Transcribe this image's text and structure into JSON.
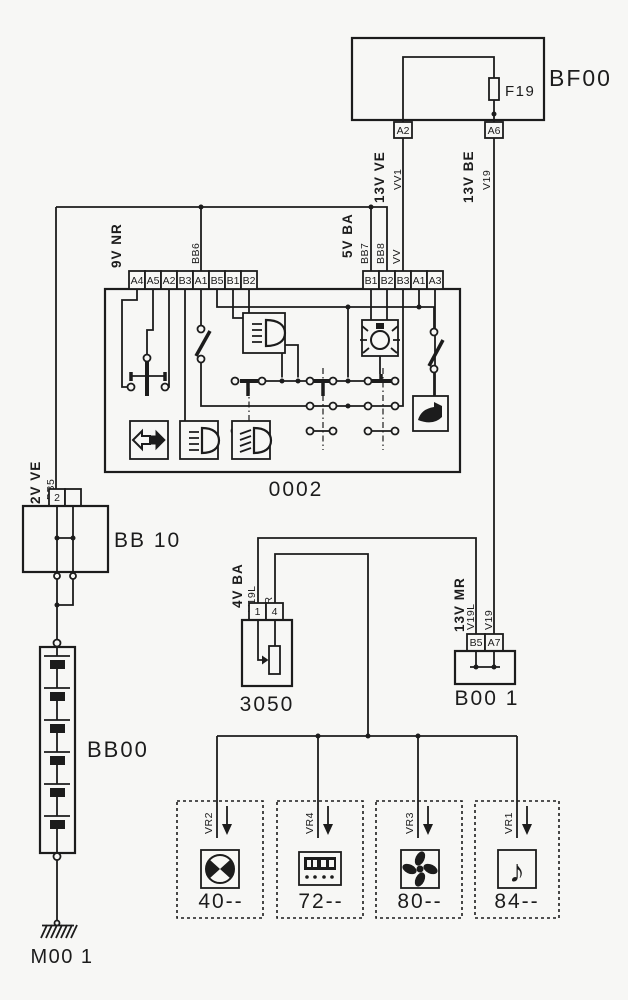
{
  "title": "wiring-diagram",
  "colors": {
    "line": "#1c1c1c",
    "paper": "#f7f7f5"
  },
  "bf00": {
    "label": "BF00",
    "fuse": "F19",
    "pin_a2": "A2",
    "pin_a6": "A6",
    "wire_a2_label": "13V VE",
    "wire_a2_code": "VV1",
    "wire_a6_label": "13V BE",
    "wire_a6_code": "V19"
  },
  "c0002": {
    "label": "0002",
    "left_bus": "9V NR",
    "left_code": "BB6",
    "left_pins": [
      "A4",
      "A5",
      "A2",
      "B3",
      "A1",
      "B5",
      "B1",
      "B2"
    ],
    "right_bus": "5V BA",
    "right_codes": [
      "BB7",
      "BB8",
      "VV"
    ],
    "right_pins": [
      "B1",
      "B2",
      "B3",
      "A1",
      "A3"
    ]
  },
  "bb10": {
    "label": "BB 10",
    "pin": "2",
    "bus": "2V VE",
    "code": "BB5"
  },
  "bb00": {
    "label": "BB00"
  },
  "m001": {
    "label": "M00 1"
  },
  "u3050": {
    "label": "3050",
    "bus": "4V BA",
    "pins": [
      "1",
      "4"
    ],
    "codes": [
      "V19L",
      "VR"
    ]
  },
  "b001": {
    "label": "B00 1",
    "bus": "13V MR",
    "pins": [
      "B5",
      "A7"
    ],
    "codes": [
      "V19L",
      "V19"
    ]
  },
  "loads": [
    {
      "wire": "VR2",
      "num": "40--",
      "icon": "air-distribution-icon"
    },
    {
      "wire": "VR4",
      "num": "72--",
      "icon": "digital-clock-icon"
    },
    {
      "wire": "VR3",
      "num": "80--",
      "icon": "fan-icon"
    },
    {
      "wire": "VR1",
      "num": "84--",
      "icon": "music-note-icon",
      "glyph": "♪"
    }
  ]
}
